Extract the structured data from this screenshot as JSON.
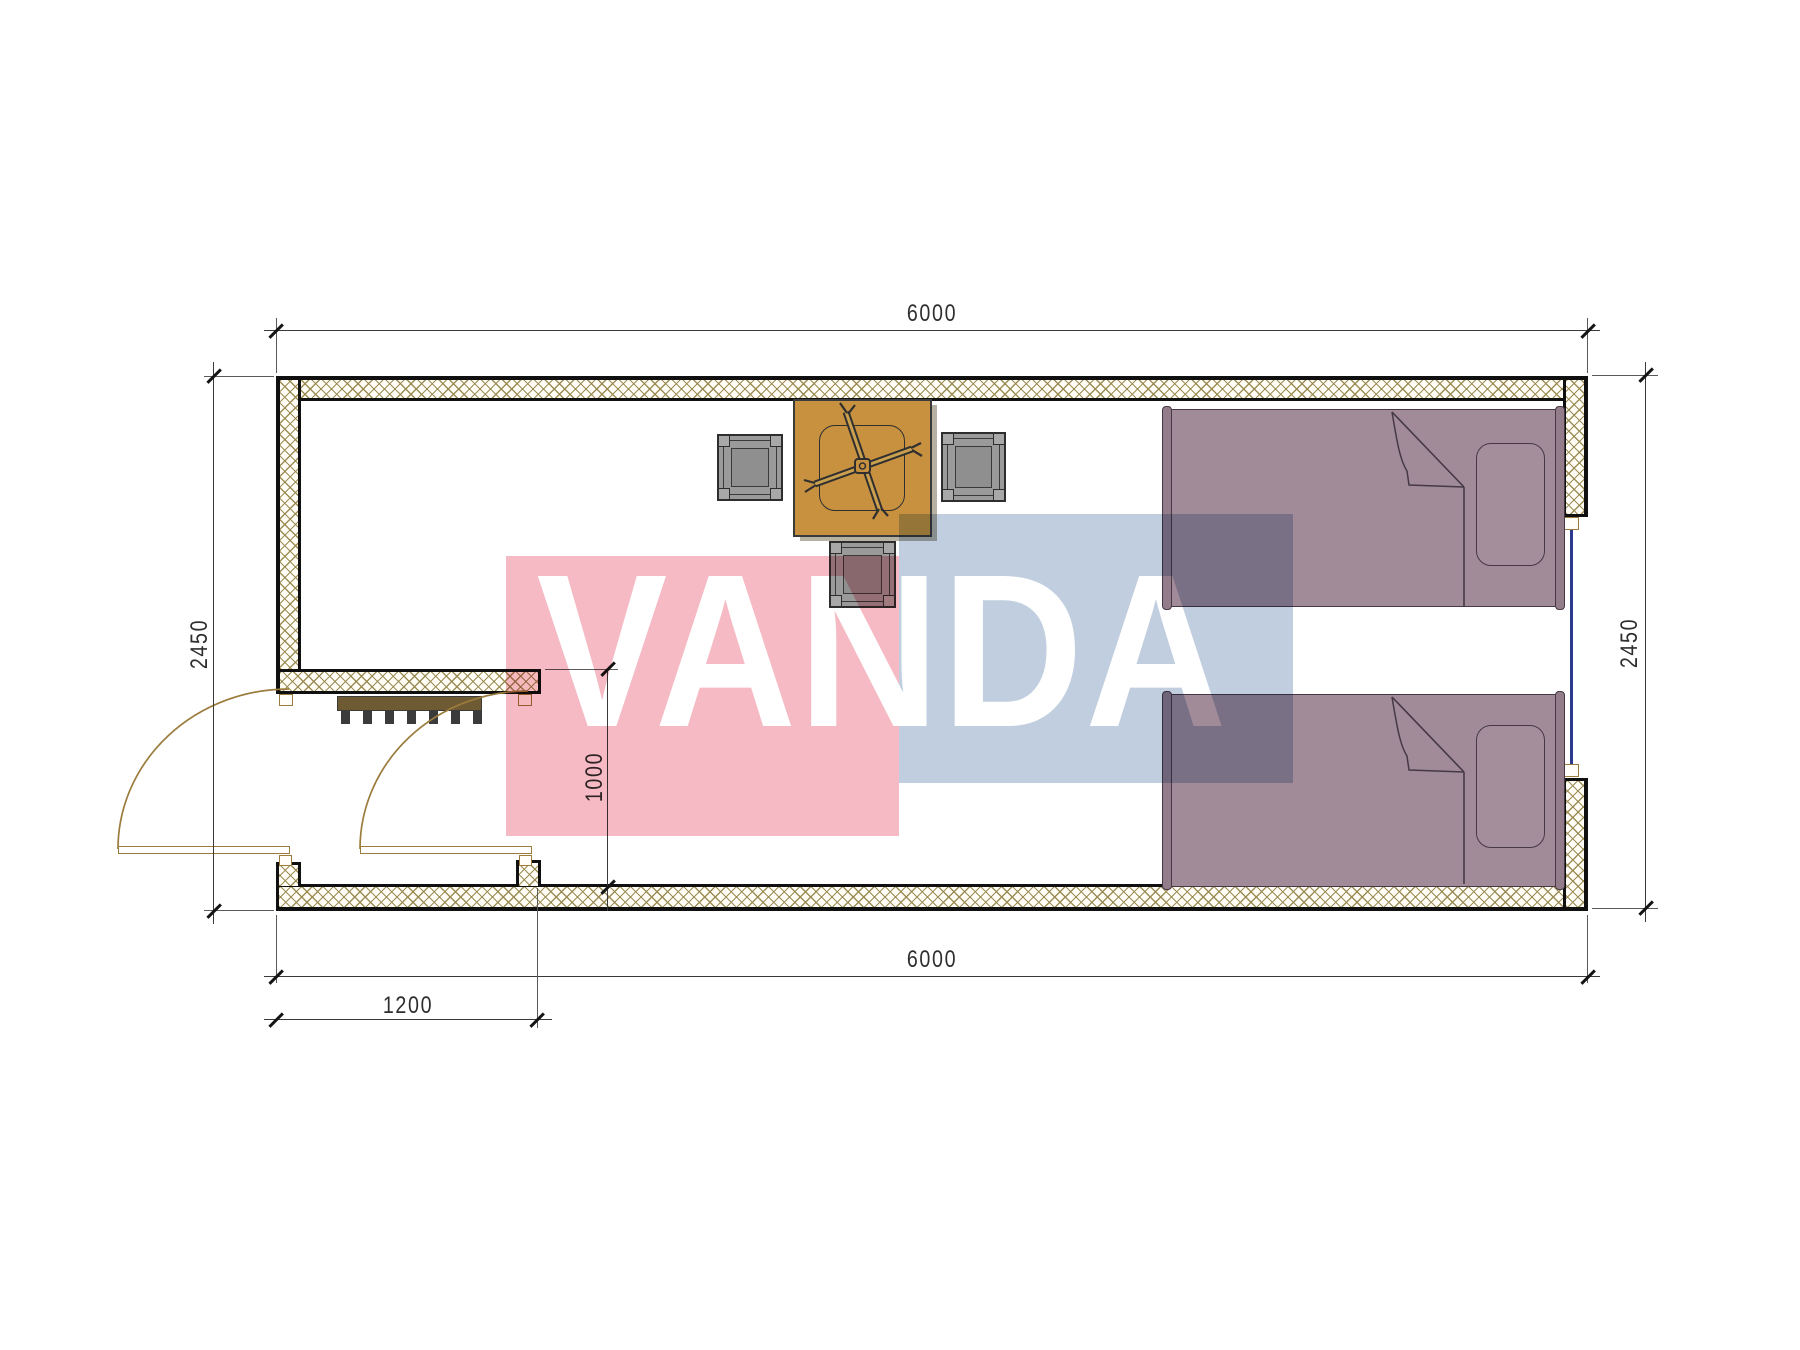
{
  "drawing": {
    "type": "floor-plan",
    "unit": "mm",
    "dims": {
      "top_width": "6000",
      "bottom_width": "6000",
      "left_height": "2450",
      "right_height": "2450",
      "entry_bay_width": "1200",
      "porch_depth": "1000"
    },
    "watermark": {
      "text": "VANDA",
      "pink": "#f5bac3",
      "blue": "#c0cedf"
    },
    "palette": {
      "wall_line": "#101010",
      "hatch_line": "#97884e",
      "door": "#9b7c3c",
      "table": "#c79140",
      "stool": "#9a9a9a",
      "bed": "#a18b99",
      "window_glass": "#2b3a8f",
      "steps": "#6f5b33"
    }
  }
}
